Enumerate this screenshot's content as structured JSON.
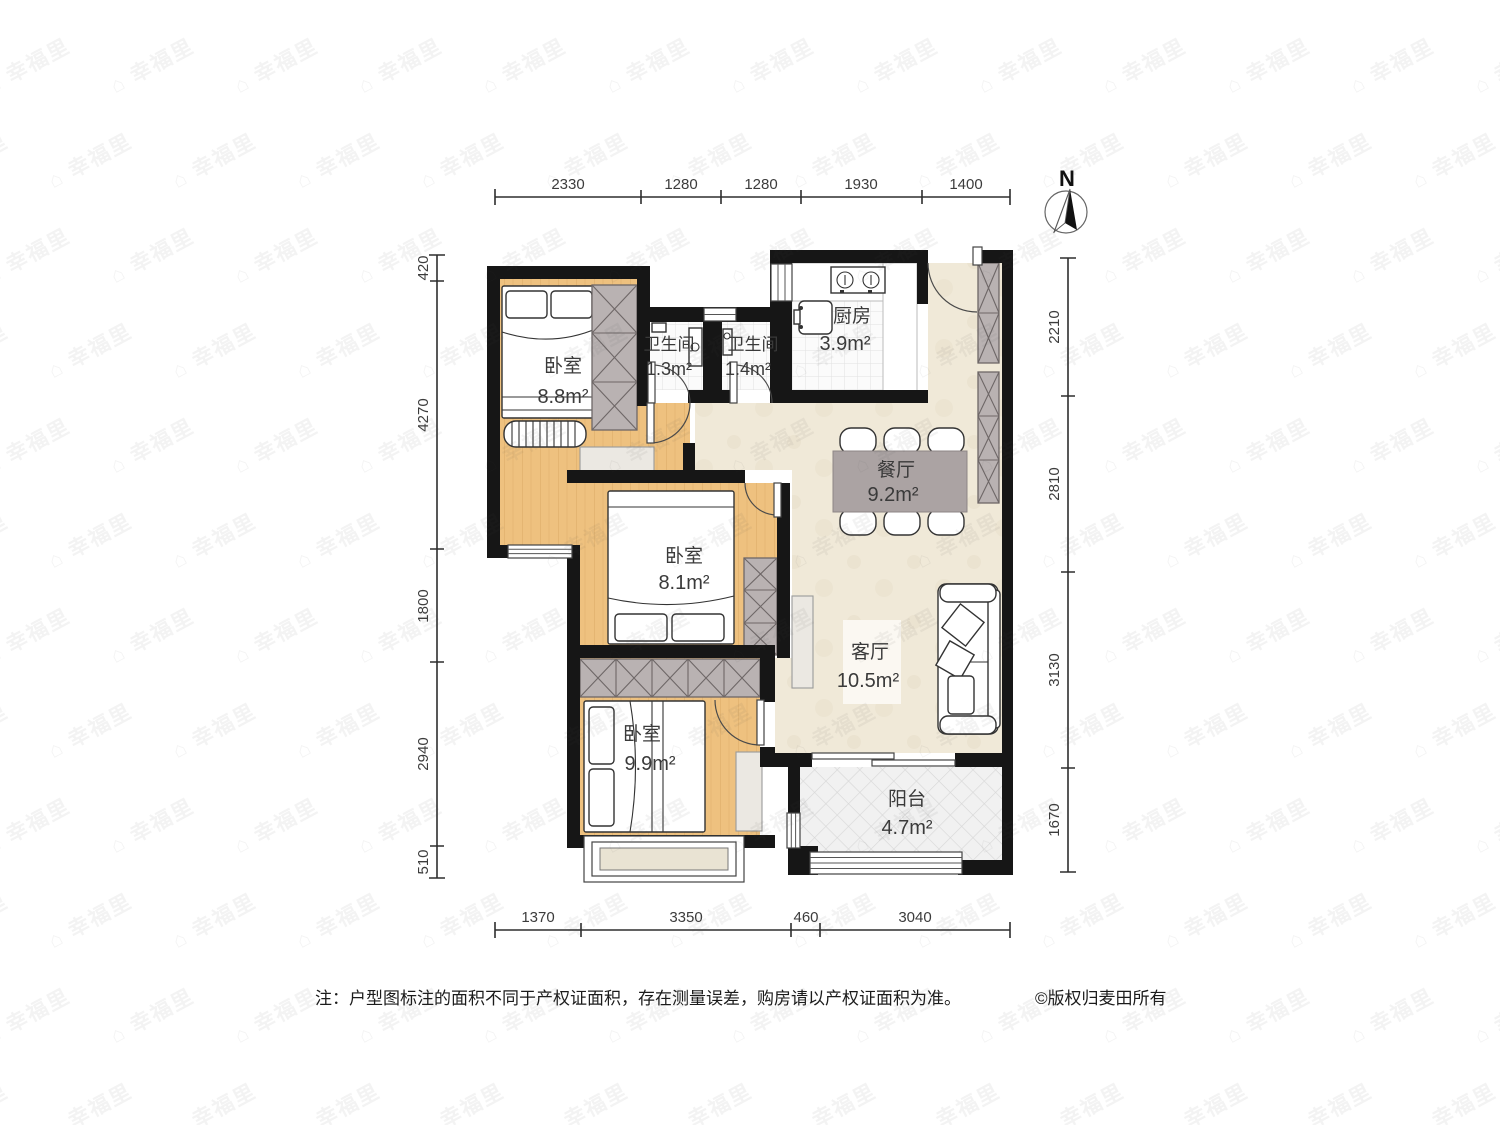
{
  "palette": {
    "wall": "#161616",
    "wood": "#eec17f",
    "wood_line": "#d9a55c",
    "cream": "#f0e9d8",
    "tile": "#fbfbfb",
    "balcony": "#f1f1f1",
    "wardrobe": "#b9b2b2",
    "table": "#aba3a3",
    "bay_fill": "#e9e3d3"
  },
  "watermark": {
    "text": "幸福里",
    "logo_glyph": "⌂"
  },
  "compass": {
    "label": "N"
  },
  "rooms": {
    "bedroom1": {
      "name": "卧室",
      "area": "8.8m²"
    },
    "bath1": {
      "name": "卫生间",
      "area": "1.3m²"
    },
    "bath2": {
      "name": "卫生间",
      "area": "1.4m²"
    },
    "kitchen": {
      "name": "厨房",
      "area": "3.9m²"
    },
    "dining": {
      "name": "餐厅",
      "area": "9.2m²"
    },
    "bedroom2": {
      "name": "卧室",
      "area": "8.1m²"
    },
    "living": {
      "name": "客厅",
      "area": "10.5m²"
    },
    "bedroom3": {
      "name": "卧室",
      "area": "9.9m²"
    },
    "balcony": {
      "name": "阳台",
      "area": "4.7m²"
    }
  },
  "dimensions": {
    "top": [
      "2330",
      "1280",
      "1280",
      "1930",
      "1400"
    ],
    "bottom": [
      "1370",
      "3350",
      "460",
      "3040"
    ],
    "left": [
      "420",
      "4270",
      "1800",
      "2940",
      "510"
    ],
    "right": [
      "2210",
      "2810",
      "3130",
      "1670"
    ]
  },
  "note": {
    "text": "注：户型图标注的面积不同于产权证面积，存在测量误差，购房请以产权证面积为准。",
    "copyright": "©版权归麦田所有"
  }
}
